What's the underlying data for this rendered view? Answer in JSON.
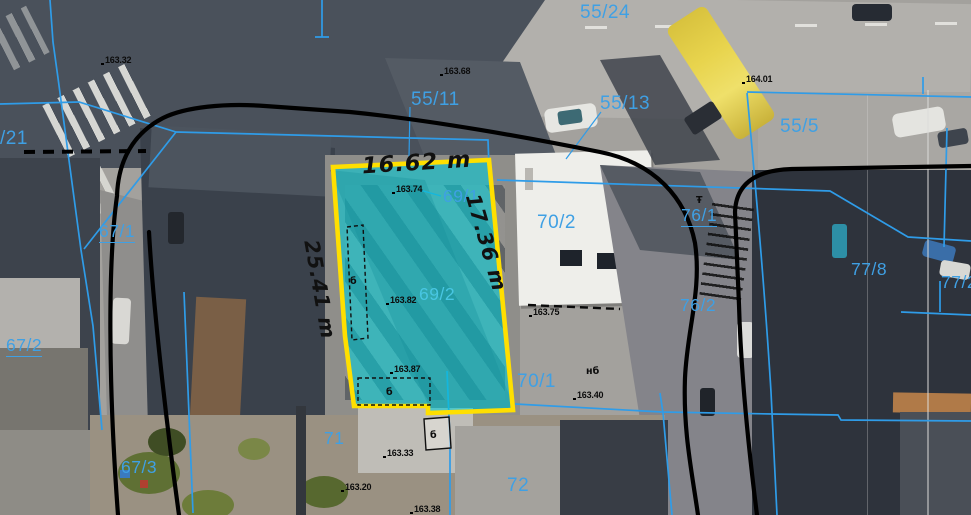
{
  "map": {
    "highlighted_parcel": {
      "fill": "#00ccd8",
      "fill_opacity": 0.58,
      "stroke": "#ffdf00",
      "measurements": [
        {
          "text": "16.62 m",
          "x": 362,
          "y": 150,
          "rotate": -3.5
        },
        {
          "text": "25.41 m",
          "x": 323,
          "y": 238,
          "rotate": 80
        },
        {
          "text": "17.36 m",
          "x": 484,
          "y": 191,
          "rotate": 74
        }
      ]
    },
    "parcel_labels": [
      {
        "text": "55/24",
        "x": 580,
        "y": 3,
        "size": 19
      },
      {
        "text": "55/11",
        "x": 411,
        "y": 90,
        "size": 19
      },
      {
        "text": "55/13",
        "x": 600,
        "y": 94,
        "size": 19
      },
      {
        "text": "55/5",
        "x": 780,
        "y": 117,
        "size": 19
      },
      {
        "text": "/21",
        "x": 0,
        "y": 129,
        "size": 19
      },
      {
        "text": "67/1",
        "x": 99,
        "y": 223,
        "underline": true
      },
      {
        "text": "67/2",
        "x": 6,
        "y": 337,
        "underline": true
      },
      {
        "text": "67/3",
        "x": 121,
        "y": 459
      },
      {
        "text": "69/1",
        "x": 443,
        "y": 188
      },
      {
        "text": "69/2",
        "x": 419,
        "y": 286,
        "light": true
      },
      {
        "text": "70/2",
        "x": 537,
        "y": 213,
        "size": 19
      },
      {
        "text": "70/1",
        "x": 517,
        "y": 372,
        "size": 19
      },
      {
        "text": "76/1",
        "x": 681,
        "y": 207,
        "underline": true
      },
      {
        "text": "76/2",
        "x": 680,
        "y": 297
      },
      {
        "text": "77/8",
        "x": 851,
        "y": 261
      },
      {
        "text": "77/2",
        "x": 941,
        "y": 274
      },
      {
        "text": "71",
        "x": 324,
        "y": 430
      },
      {
        "text": "72",
        "x": 507,
        "y": 476,
        "size": 19
      }
    ],
    "elevation_points": [
      {
        "text": "163.32",
        "x": 105,
        "y": 56
      },
      {
        "text": "163.68",
        "x": 444,
        "y": 67
      },
      {
        "text": "164.01",
        "x": 746,
        "y": 75
      },
      {
        "text": "163.74",
        "x": 396,
        "y": 185
      },
      {
        "text": "163.82",
        "x": 390,
        "y": 296
      },
      {
        "text": "163.87",
        "x": 394,
        "y": 365
      },
      {
        "text": "163.75",
        "x": 533,
        "y": 308
      },
      {
        "text": "163.40",
        "x": 577,
        "y": 391
      },
      {
        "text": "163.33",
        "x": 387,
        "y": 449
      },
      {
        "text": "163.20",
        "x": 345,
        "y": 483
      },
      {
        "text": "163.38",
        "x": 414,
        "y": 505
      }
    ],
    "building_marks": [
      {
        "text": "б",
        "x": 350,
        "y": 277
      },
      {
        "text": "б",
        "x": 386,
        "y": 388
      },
      {
        "text": "б",
        "x": 430,
        "y": 431
      },
      {
        "text": "нб",
        "x": 586,
        "y": 367
      },
      {
        "text": "Ŧ",
        "x": 696,
        "y": 196
      }
    ],
    "colors": {
      "parcel_fill": "#00ccd8",
      "parcel_stroke": "#ffdf00",
      "cadastral_blue": "#2f9ce8",
      "parcel_label_blue": "#3fa0e4",
      "parcel_label_light": "#48c6e2",
      "boundary_black": "#000000",
      "dimension_text": "#111111"
    }
  }
}
